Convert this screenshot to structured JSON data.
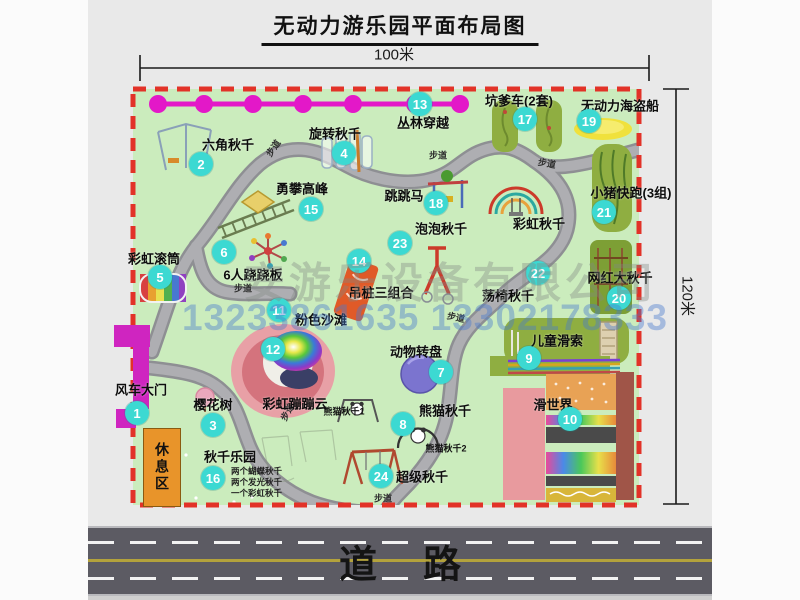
{
  "title": "无动力游乐园平面布局图",
  "dimensions": {
    "width_label": "100米",
    "height_label": "120米"
  },
  "road": {
    "label": "道路"
  },
  "rest_area_label": "休息区",
  "walkway_label": "步道",
  "watermark": {
    "company": "安游乐设备有限公司",
    "phone": "13233861635 13302178333"
  },
  "extra_labels": {
    "rainbow_swing": "彩虹秋千",
    "panda1": "熊猫秋千1",
    "panda2": "熊猫秋千2"
  },
  "swing_park_notes": [
    "两个蝴蝶秋千",
    "两个发光秋千",
    "一个彩虹秋千"
  ],
  "attractions": [
    {
      "num": 1,
      "name": "风车大门"
    },
    {
      "num": 2,
      "name": "六角秋千"
    },
    {
      "num": 3,
      "name": "樱花树"
    },
    {
      "num": 4,
      "name": "旋转秋千"
    },
    {
      "num": 5,
      "name": "彩虹滚筒"
    },
    {
      "num": 6,
      "name": "6人跷跷板"
    },
    {
      "num": 7,
      "name": "动物转盘"
    },
    {
      "num": 8,
      "name": "熊猫秋千"
    },
    {
      "num": 9,
      "name": "儿童滑索"
    },
    {
      "num": 10,
      "name": "滑世界"
    },
    {
      "num": 11,
      "name": "粉色沙滩"
    },
    {
      "num": 12,
      "name": "彩虹蹦蹦云"
    },
    {
      "num": 13,
      "name": "丛林穿越"
    },
    {
      "num": 14,
      "name": "吊桩三组合"
    },
    {
      "num": 15,
      "name": "勇攀高峰"
    },
    {
      "num": 16,
      "name": "秋千乐园"
    },
    {
      "num": 17,
      "name": "坑爹车(2套)"
    },
    {
      "num": 18,
      "name": "跳跳马"
    },
    {
      "num": 19,
      "name": "无动力海盗船"
    },
    {
      "num": 20,
      "name": "网红大秋千"
    },
    {
      "num": 21,
      "name": "小猪快跑(3组)"
    },
    {
      "num": 22,
      "name": "荡椅秋千"
    },
    {
      "num": 23,
      "name": "泡泡秋千"
    },
    {
      "num": 24,
      "name": "超级秋千"
    }
  ],
  "colors": {
    "map_green": "#cbecbd",
    "border_red": "#e23228",
    "badge_cyan": "#3cd9d2",
    "gate_magenta": "#cf25c0",
    "zipline_magenta": "#e318c8",
    "road_gray": "#5c5b63",
    "rest_orange": "#e8942a",
    "equip_olive": "#8fae41"
  }
}
